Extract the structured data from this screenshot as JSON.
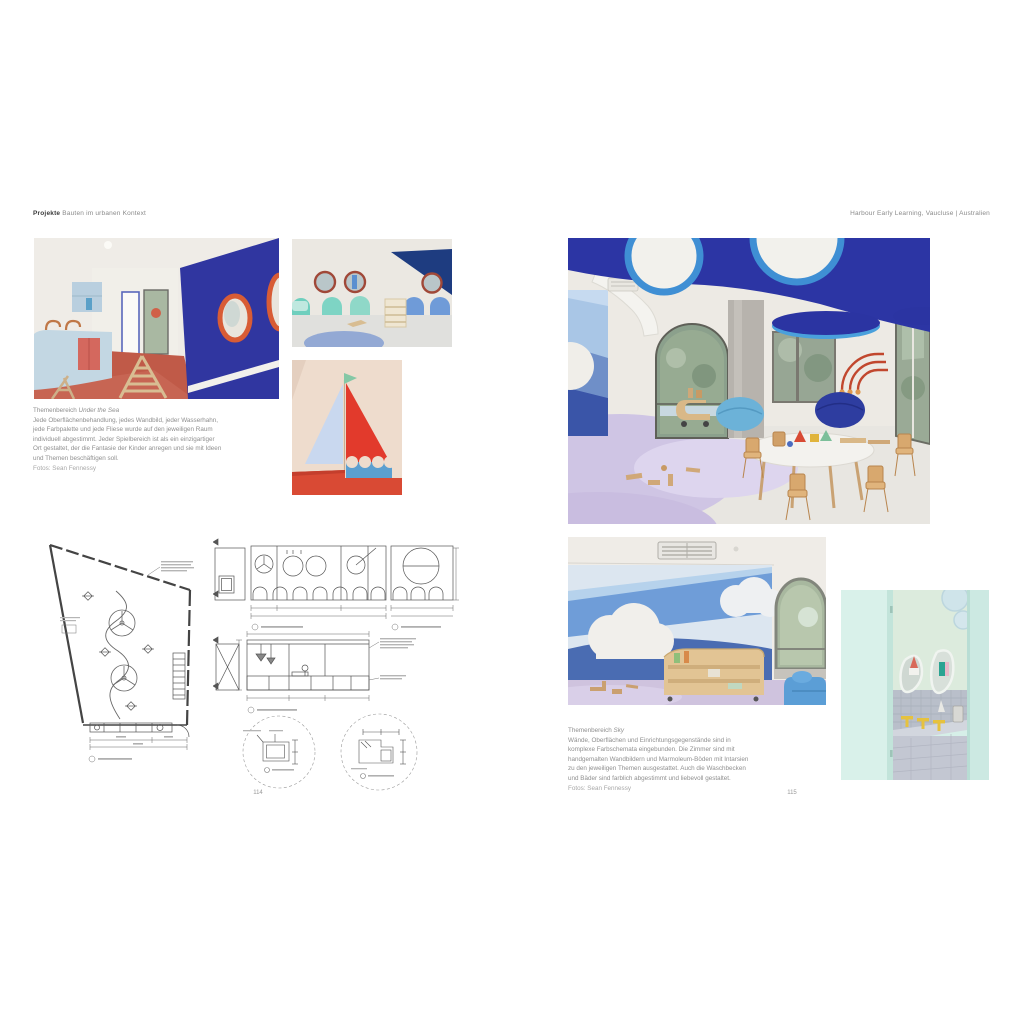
{
  "header": {
    "section_bold": "Projekte",
    "section_rest": " Bauten im urbanen Kontext",
    "project": "Harbour Early Learning, Vaucluse | Australien"
  },
  "left_page": {
    "page_number": "114",
    "caption": {
      "title_prefix": "Themenbereich ",
      "title_italic": "Under the Sea",
      "body": "Jede Oberflächenbehandlung, jedes Wandbild, jeder Wasserhahn,\njede Farbpalette und jede Fliese wurde auf den jeweiligen Raum\nindividuell abgestimmt. Jeder Spielbereich ist als ein einzigartiger\nOrt gestaltet, der die Fantasie der Kinder anregen und sie mit Ideen\nund Themen beschäftigen soll.",
      "credit": "Fotos: Sean Fennessy"
    }
  },
  "right_page": {
    "page_number": "115",
    "caption": {
      "title_prefix": "Themenbereich ",
      "title_italic": "Sky",
      "body": "Wände, Oberflächen und Einrichtungsgegenstände sind in\nkomplexe Farbschemata eingebunden. Die Zimmer sind mit\nhandgemalten Wandbildern und Marmoleum-Böden mit Intarsien\nzu den jeweiligen Themen ausgestattet. Auch die Waschbecken\nund Bäder sind farblich abgestimmt und liebevoll gestaltet.",
      "credit": "Fotos: Sean Fennessy"
    }
  },
  "palette": {
    "deep_blue_ceiling": "#2c35a4",
    "sky_blue_ring": "#4aa0dc",
    "navy_triangle": "#1e3c80",
    "teal_wave": "#6fcfbe",
    "mural_light_blue": "#b6d2ec",
    "mural_mid_blue": "#6f9dd8",
    "mural_dark_blue": "#4a6cb2",
    "sail_red": "#e23a2c",
    "terracotta_floor": "#c05a48",
    "porthole_orange": "#d85c35",
    "lavender_floor": "#d6cde8",
    "kitchen_light_blue": "#c3d7e3",
    "bathroom_mint": "#d6efe6",
    "faucet_yellow": "#e6c23e",
    "wood": "#d9b887",
    "caption_grey": "#8f8f8f"
  }
}
